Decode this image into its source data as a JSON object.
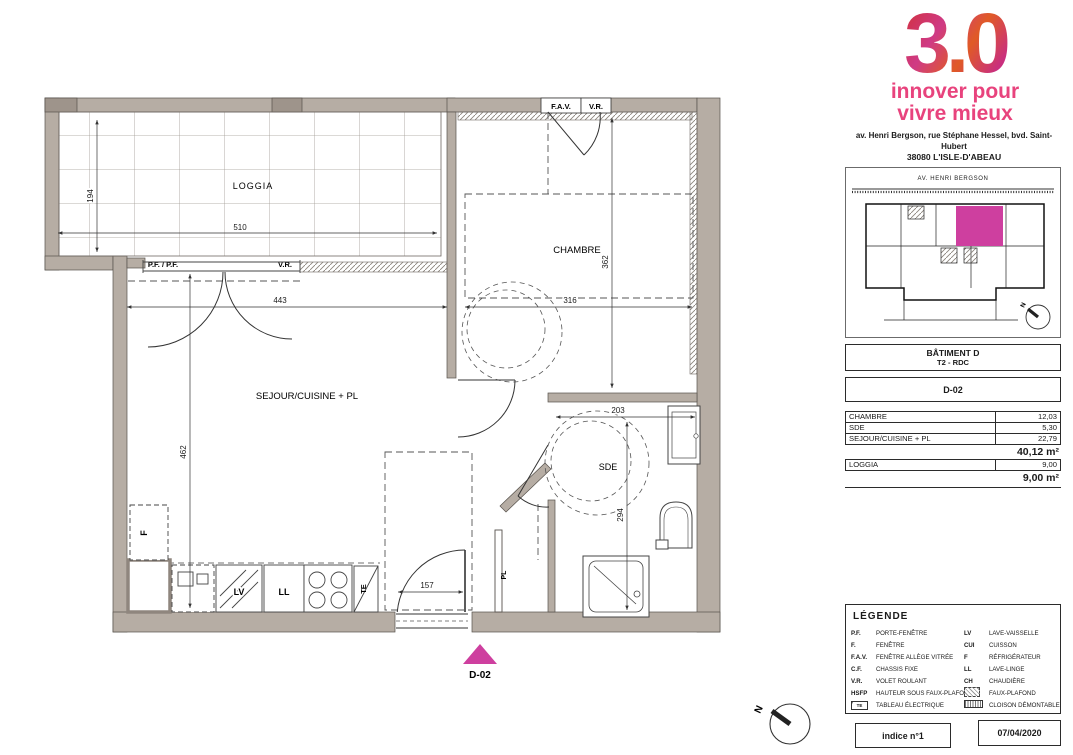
{
  "colors": {
    "wall": "#b6ada4",
    "accent_pink": "#ce3f9f",
    "logo_pink": "#e8437d"
  },
  "brand": {
    "logo_text": "3.0",
    "tagline_line1": "innover pour",
    "tagline_line2": "vivre mieux",
    "address_line1": "av. Henri Bergson, rue Stéphane Hessel, bvd. Saint-Hubert",
    "address_line2": "38080 L'ISLE-D'ABEAU"
  },
  "siteplan": {
    "street": "AV. HENRI BERGSON",
    "north": "N"
  },
  "info": {
    "batiment": "BÂTIMENT D",
    "type_floor": "T2 - RDC",
    "unit": "D-02"
  },
  "areas": {
    "rows": [
      {
        "label": "CHAMBRE",
        "value": "12,03"
      },
      {
        "label": "SDE",
        "value": "5,30"
      },
      {
        "label": "SEJOUR/CUISINE + PL",
        "value": "22,79"
      }
    ],
    "total_main": "40,12 m²",
    "loggia_row": {
      "label": "LOGGIA",
      "value": "9,00"
    },
    "total_loggia": "9,00 m²"
  },
  "legend": {
    "title": "LÉGENDE",
    "left": [
      {
        "abbr": "P.F.",
        "label": "PORTE-FENÊTRE"
      },
      {
        "abbr": "F.",
        "label": "FENÊTRE"
      },
      {
        "abbr": "F.A.V.",
        "label": "FENÊTRE ALLÈGE VITRÉE"
      },
      {
        "abbr": "C.F.",
        "label": "CHASSIS FIXE"
      },
      {
        "abbr": "V.R.",
        "label": "VOLET ROULANT"
      },
      {
        "abbr": "HSFP",
        "label": "HAUTEUR SOUS FAUX-PLAFOND"
      },
      {
        "abbr": "TE",
        "label": "TABLEAU ÉLECTRIQUE",
        "icon": "te-box"
      }
    ],
    "right": [
      {
        "abbr": "LV",
        "label": "LAVE-VAISSELLE"
      },
      {
        "abbr": "CUI",
        "label": "CUISSON"
      },
      {
        "abbr": "F",
        "label": "RÉFRIGÉRATEUR"
      },
      {
        "abbr": "LL",
        "label": "LAVE-LINGE"
      },
      {
        "abbr": "CH",
        "label": "CHAUDIÈRE"
      },
      {
        "abbr": "",
        "label": "FAUX-PLAFOND",
        "icon": "faux-plafond-hatch"
      },
      {
        "abbr": "",
        "label": "CLOISON DÉMONTABLE",
        "icon": "cloison-hatch"
      }
    ]
  },
  "footer": {
    "indice": "indice n°1",
    "date": "07/04/2020"
  },
  "plan": {
    "rooms": {
      "loggia": "LOGGIA",
      "chambre": "CHAMBRE",
      "sejour": "SEJOUR/CUISINE + PL",
      "sde": "SDE"
    },
    "dims": {
      "loggia_depth": "194",
      "loggia_width": "510",
      "sejour_width": "443",
      "chambre_width": "316",
      "chambre_depth": "362",
      "sejour_depth": "462",
      "sde_width": "203",
      "sde_depth": "294",
      "entry_width": "157"
    },
    "openings": {
      "fav": "F.A.V.",
      "vr_top": "V.R.",
      "pf_pf": "P.F. / P.F.",
      "vr_left": "V.R."
    },
    "fixtures": {
      "fridge": "F",
      "dishwasher": "LV",
      "washer": "LL",
      "electrical": "TE",
      "closet": "PL"
    },
    "unit_marker": "D-02",
    "compass_north": "N"
  }
}
